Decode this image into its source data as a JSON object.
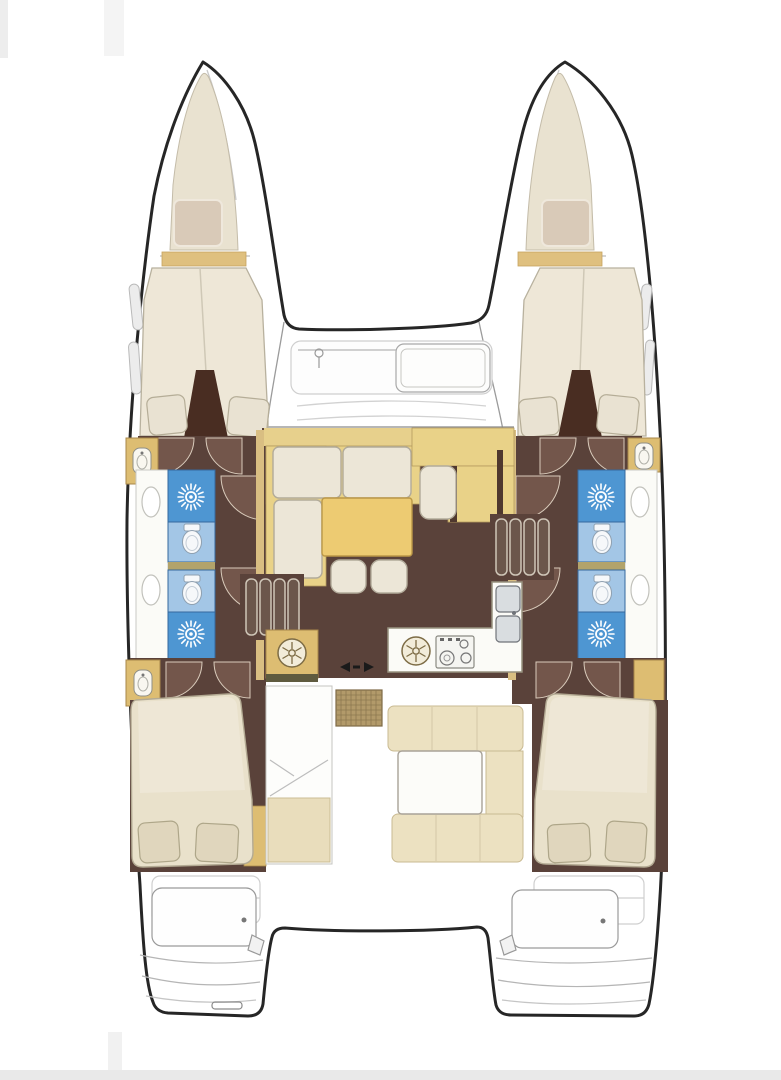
{
  "image": {
    "kind": "catamaran-yacht-floorplan",
    "view": "top-down deck plan",
    "visible_text": []
  },
  "palette": {
    "background": "#ffffff",
    "hull_outline": "#262626",
    "deck_line_gray": "#bdbdbd",
    "floor_dark_brown": "#5a423a",
    "door_swing_brown": "#73564b",
    "partition_dark": "#492d22",
    "wood_tan": "#ddbd72",
    "bench_tan": "#e9d288",
    "table_gold": "#edcb72",
    "cushion_cream": "#ece6d7",
    "bed_cream": "#e9e1cb",
    "pillow_beige": "#e0d6bd",
    "bathroom_blue": "#4e96d2",
    "bathroom_blue_light": "#a3c6e6",
    "counter_white": "#fbfbf7",
    "cockpit_cushion": "#ece1c1",
    "grating_teak": "#b29a6a",
    "bottom_band_gray": "#e9e9e9"
  },
  "vessel": {
    "hulls": [
      "port-hull",
      "starboard-hull"
    ],
    "rooms": [
      "port-bow-locker",
      "port-forward-cabin",
      "port-forward-bathroom",
      "port-aft-bathroom",
      "port-aft-cabin",
      "starboard-bow-locker",
      "starboard-forward-cabin",
      "starboard-forward-bathroom",
      "starboard-aft-bathroom",
      "starboard-aft-cabin",
      "salon",
      "galley",
      "navigation-station",
      "forward-cockpit",
      "aft-cockpit"
    ],
    "furniture": [
      "v-berth-bed",
      "double-bed",
      "l-shaped-sofa",
      "salon-table",
      "ottomans",
      "nav-seat",
      "cockpit-u-bench",
      "cockpit-table",
      "teak-grating",
      "engine-hatches",
      "transom-steps"
    ],
    "fixtures": [
      "shower",
      "toilet",
      "washbasin",
      "double-sink",
      "round-sink",
      "stove",
      "washing-machine",
      "companionway-steps",
      "sliding-door"
    ]
  }
}
